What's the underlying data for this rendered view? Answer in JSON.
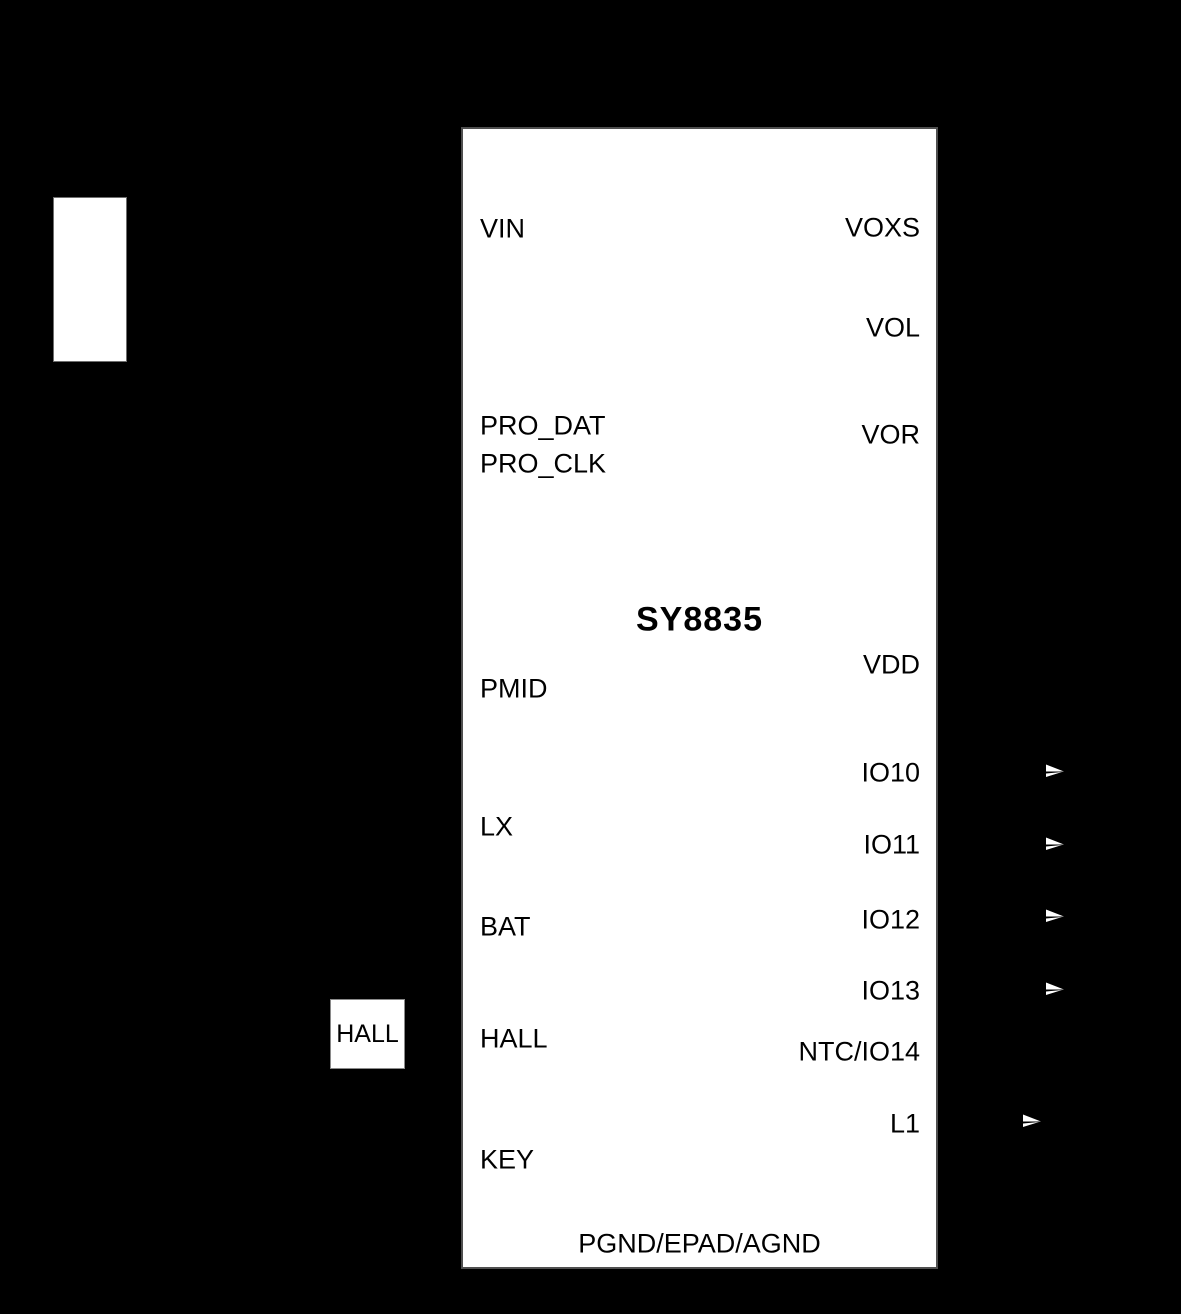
{
  "colors": {
    "background": "#000000",
    "chip_fill": "#ffffff",
    "chip_border": "#4f4f4f",
    "text": "#000000",
    "arrow": "#ffffff"
  },
  "chip": {
    "title": "SY8835",
    "left_pins": [
      "VIN",
      "PRO_DAT",
      "PRO_CLK",
      "PMID",
      "LX",
      "BAT",
      "HALL",
      "KEY"
    ],
    "right_pins": [
      "VOXS",
      "VOL",
      "VOR",
      "VDD",
      "IO10",
      "IO11",
      "IO12",
      "IO13",
      "NTC/IO14",
      "L1"
    ],
    "bottom_pin": "PGND/EPAD/AGND"
  },
  "components": {
    "hall_box_label": "HALL"
  }
}
